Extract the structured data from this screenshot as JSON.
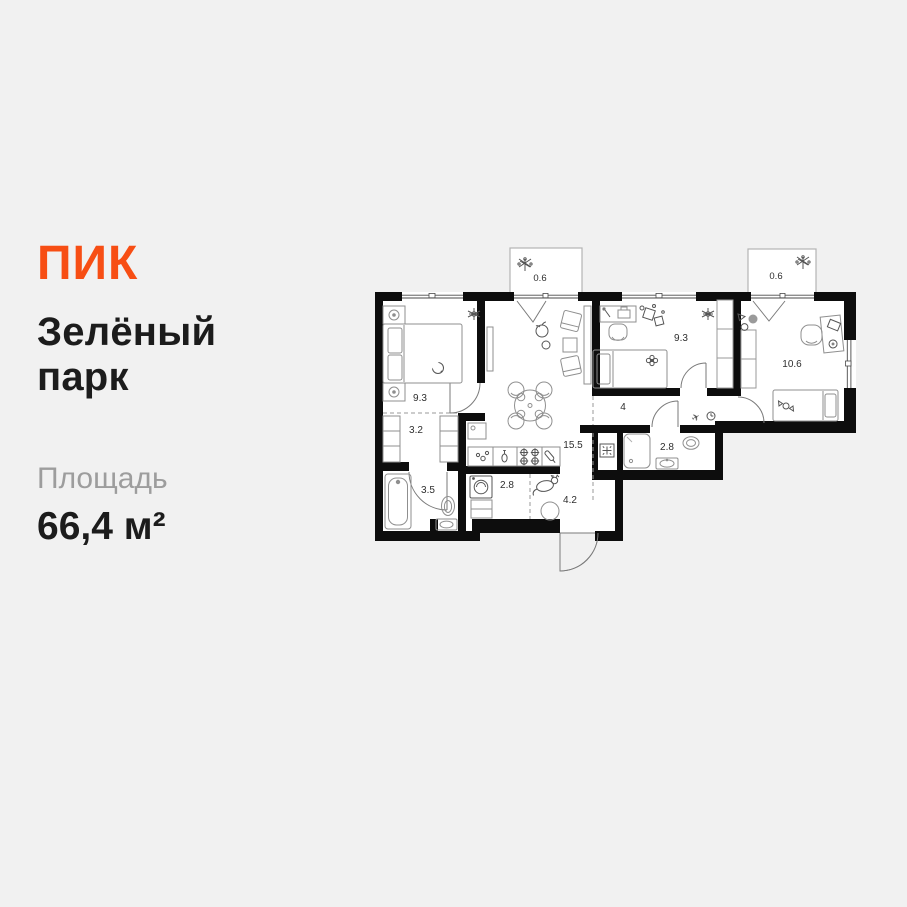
{
  "brand": {
    "logo": "ПИК",
    "color": "#F74E14"
  },
  "listing": {
    "title_line1": "Зелёный",
    "title_line2": "парк",
    "area_label": "Площадь",
    "area_value": "66,4 м²"
  },
  "floorplan": {
    "total_area_m2": "66,4",
    "icons": {
      "plane": "✈"
    },
    "rooms": [
      {
        "id": "bedroom-1",
        "area": "9.3"
      },
      {
        "id": "wardrobe",
        "area": "3.2"
      },
      {
        "id": "bathroom-1",
        "area": "3.5"
      },
      {
        "id": "laundry",
        "area": "2.8"
      },
      {
        "id": "kitchen-living",
        "area": "15.5"
      },
      {
        "id": "entry-hall",
        "area": "4.2"
      },
      {
        "id": "corridor",
        "area": "4"
      },
      {
        "id": "bathroom-2",
        "area": "2.8"
      },
      {
        "id": "bedroom-2",
        "area": "9.3"
      },
      {
        "id": "bedroom-3",
        "area": "10.6"
      },
      {
        "id": "balcony-1",
        "area": "0.6"
      },
      {
        "id": "balcony-2",
        "area": "0.6"
      }
    ]
  }
}
